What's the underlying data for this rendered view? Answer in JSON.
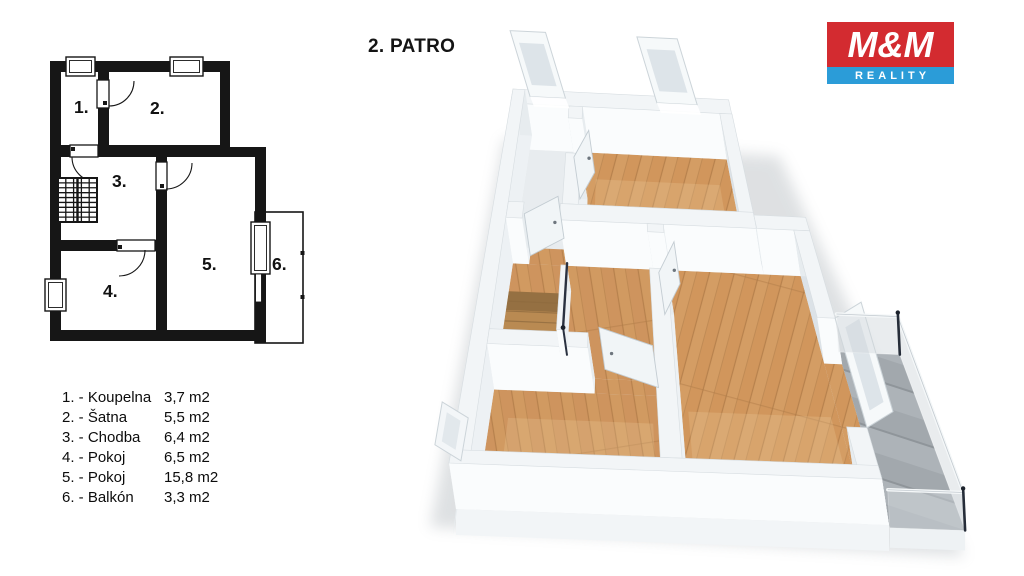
{
  "title": "2. PATRO",
  "logo": {
    "top": "M&M",
    "bottom": "REALITY",
    "red": "#d32b30",
    "blue": "#2b9cd8"
  },
  "legend": {
    "rows": [
      {
        "name": "1. - Koupelna",
        "area": "3,7 m2"
      },
      {
        "name": "2. - Šatna",
        "area": "5,5 m2"
      },
      {
        "name": "3. - Chodba",
        "area": "6,4 m2"
      },
      {
        "name": "4. - Pokoj",
        "area": "6,5 m2"
      },
      {
        "name": "5. - Pokoj",
        "area": "15,8 m2"
      },
      {
        "name": "6. - Balkón",
        "area": "3,3 m2"
      }
    ]
  },
  "plan2d": {
    "ink": "#161616",
    "walls": [
      [
        50,
        61,
        230,
        72
      ],
      [
        50,
        61,
        61,
        341
      ],
      [
        98,
        61,
        109,
        147
      ],
      [
        220,
        61,
        230,
        157
      ],
      [
        50,
        145,
        230,
        157
      ],
      [
        220,
        147,
        266,
        157
      ],
      [
        255,
        147,
        266,
        343
      ],
      [
        156,
        157,
        167,
        330
      ],
      [
        50,
        240,
        167,
        251
      ],
      [
        50,
        330,
        266,
        341
      ]
    ],
    "balcony": {
      "rect": [
        255,
        212,
        303,
        343
      ],
      "ticks": [
        [
          300.5,
          251
        ],
        [
          300.5,
          295
        ]
      ]
    },
    "windows": [
      {
        "r": [
          66,
          57,
          95,
          76
        ]
      },
      {
        "r": [
          170,
          57,
          203,
          76
        ]
      },
      {
        "r": [
          45,
          279,
          66,
          311
        ]
      },
      {
        "r": [
          251,
          222,
          270,
          274
        ]
      }
    ],
    "glass_door": [
      255.5,
      274,
      6,
      28
    ],
    "doors": [
      {
        "leaf": [
          97,
          80,
          12,
          28
        ],
        "arc": "M 109 106 A 25 25 0 0 0 134 81",
        "dot": [
          103,
          101
        ]
      },
      {
        "leaf": [
          70,
          145,
          28,
          12
        ],
        "arc": "M 72 157 A 25 25 0 0 0 97 182",
        "dot": [
          71,
          147
        ]
      },
      {
        "leaf": [
          156,
          162,
          11,
          28
        ],
        "arc": "M 166 189 A 26 26 0 0 0 192 163",
        "dot": [
          160,
          184
        ]
      },
      {
        "leaf": [
          117,
          240,
          38,
          11
        ],
        "arc": "M 145 250 A 26 26 0 0 1 119 276",
        "dot": [
          118,
          245
        ]
      }
    ],
    "stairs": {
      "rect": [
        58,
        178,
        97,
        222
      ],
      "cols": 5,
      "rows": 9,
      "mid": 77.5
    },
    "labels": [
      {
        "t": "1.",
        "x": 74,
        "y": 113
      },
      {
        "t": "2.",
        "x": 150,
        "y": 114
      },
      {
        "t": "3.",
        "x": 112,
        "y": 187
      },
      {
        "t": "4.",
        "x": 103,
        "y": 297
      },
      {
        "t": "5.",
        "x": 202,
        "y": 270
      },
      {
        "t": "6.",
        "x": 272,
        "y": 270
      }
    ]
  },
  "plan3d": {
    "quad": {
      "nw": [
        520,
        135
      ],
      "ne": [
        779,
        148
      ],
      "sw": [
        456,
        509
      ],
      "se": [
        889,
        525
      ]
    },
    "plan_size": [
      215,
      279
    ],
    "wall_h": [
      -7,
      -46
    ],
    "palette": {
      "wall_top": "#f2f5f7",
      "wall_edge": "#d7dde1",
      "face_s": "#fafcfd",
      "face_n": "#e7ecef",
      "face_w": "#dce2e7",
      "face_e": "#edf1f4",
      "door": "#f1f5f7",
      "door_edge": "#c3ccd2",
      "frame": "#f6f9fa",
      "frame_edge": "#ccd4d9",
      "frame_in": "#dde4e9",
      "bath": "#e8ecef",
      "navy": "#2a3140",
      "post": "#262d39",
      "glass": "#d3d9dd",
      "rail": "#f4f7f8",
      "shadow": "#9aa2a8",
      "tread": "#8f6b3e",
      "hole": "#b98a52",
      "hole_shade": "#6b4f2e"
    },
    "floors": [
      {
        "name": "room2-floor",
        "rect": [
          58.3,
          10.5,
          169.3,
          83.3
        ],
        "fill": "wood_r"
      },
      {
        "name": "room1-floor",
        "rect": [
          10,
          10.5,
          47.3,
          83.3
        ],
        "fill": "bath"
      },
      {
        "name": "room3-floor",
        "rect": [
          10,
          95.3,
          105.3,
          178.3
        ],
        "fill": "wood_l"
      },
      {
        "name": "room3-doorway-floor",
        "rect": [
          67.3,
          178.3,
          105.3,
          189.3
        ],
        "fill": "wood_l"
      },
      {
        "name": "room4-floor",
        "rect": [
          10,
          189.3,
          105.3,
          269
        ],
        "fill": "wood_l"
      },
      {
        "name": "room5-floor",
        "rect": [
          116.3,
          95.3,
          204.3,
          269
        ],
        "fill": "wood_r"
      },
      {
        "name": "threshold-1",
        "rect": [
          20.9,
          83.3,
          46,
          95.3
        ],
        "fill": "wood_l"
      },
      {
        "name": "threshold-2",
        "rect": [
          47.3,
          19.3,
          58.3,
          45.3
        ],
        "fill": "wood_r"
      },
      {
        "name": "threshold-3",
        "rect": [
          105.3,
          101.3,
          116.3,
          128.3
        ],
        "fill": "wood_r"
      },
      {
        "name": "threshold-4",
        "rect": [
          204.3,
          160,
          215,
          241
        ],
        "fill": "wood_r"
      },
      {
        "name": "balcony-floor",
        "rect": [
          215,
          151,
          252.3,
          281
        ],
        "fill": "conc"
      }
    ],
    "walls": [
      [
        0,
        0,
        179,
        10.5
      ],
      [
        0,
        0,
        10,
        279
      ],
      [
        47.3,
        10.5,
        58.3,
        19.3
      ],
      [
        47.3,
        45.3,
        58.3,
        83.3
      ],
      [
        169.3,
        10.5,
        179.3,
        85.3
      ],
      [
        10,
        83.3,
        20.9,
        95.3
      ],
      [
        46,
        83.3,
        179.3,
        95.3
      ],
      [
        179.3,
        85.3,
        215,
        95.3
      ],
      [
        204.3,
        95.3,
        215,
        160
      ],
      [
        204.3,
        241,
        215,
        279
      ],
      [
        105.3,
        95.3,
        116.3,
        101.3
      ],
      [
        105.3,
        128.3,
        116.3,
        269
      ],
      [
        10,
        178.3,
        67.3,
        189.3
      ],
      [
        0,
        269,
        215,
        279
      ]
    ],
    "stairs": {
      "hole": [
        10,
        116,
        46.3,
        160.3
      ],
      "treads": 5,
      "guard": [
        46.3,
        114,
        50.3,
        162
      ],
      "rail_h": [
        -4,
        -28
      ]
    },
    "doors": [
      {
        "h": [
          21,
          89
        ],
        "t": [
          43,
          75
        ]
      },
      {
        "h": [
          104,
          183
        ],
        "t": [
          73,
          171
        ]
      },
      {
        "h": [
          110.5,
          128.3
        ],
        "t": [
          122,
          105
        ]
      },
      {
        "h": [
          52.6,
          45.3
        ],
        "t": [
          63,
          25
        ]
      }
    ],
    "win_north": [
      {
        "a": 15,
        "b": 44
      },
      {
        "a": 119,
        "b": 152
      }
    ],
    "win_west": {
      "y1": 217,
      "y2": 249
    },
    "balcony_door": {
      "y1": 160,
      "y2": 241
    },
    "balcony": {
      "x1": 215,
      "x2": 252.3,
      "y1": 151,
      "y2": 281
    }
  }
}
